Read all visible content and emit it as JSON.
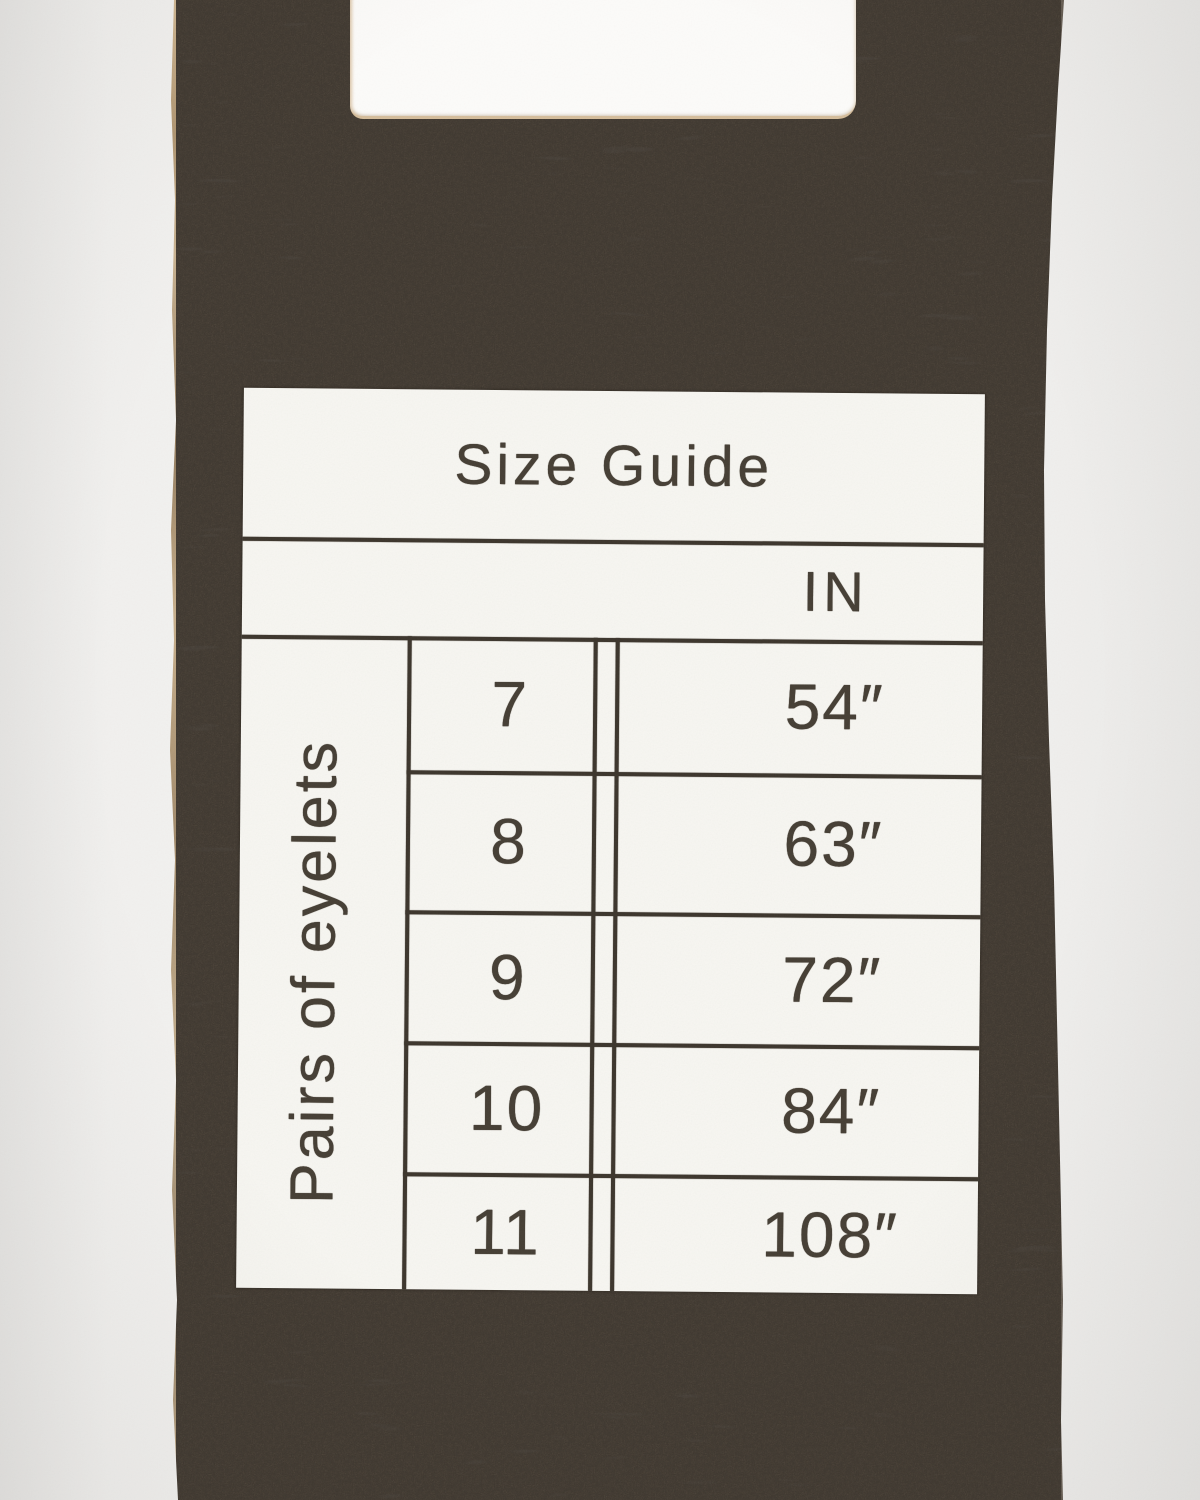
{
  "colors": {
    "backdrop": "#f3f2f0",
    "suede": "#3b342c",
    "leather_cut_edge": "#d6bd99",
    "sticker_paper": "#f8f7f2",
    "print_ink": "#453e34"
  },
  "size_guide": {
    "title": "Size Guide",
    "unit_header": "IN",
    "row_axis_label": "Pairs of eyelets",
    "rows": [
      {
        "eyelets": "7",
        "length_in": "54″"
      },
      {
        "eyelets": "8",
        "length_in": "63″"
      },
      {
        "eyelets": "9",
        "length_in": "72″"
      },
      {
        "eyelets": "10",
        "length_in": "84″"
      },
      {
        "eyelets": "11",
        "length_in": "108″"
      }
    ]
  }
}
